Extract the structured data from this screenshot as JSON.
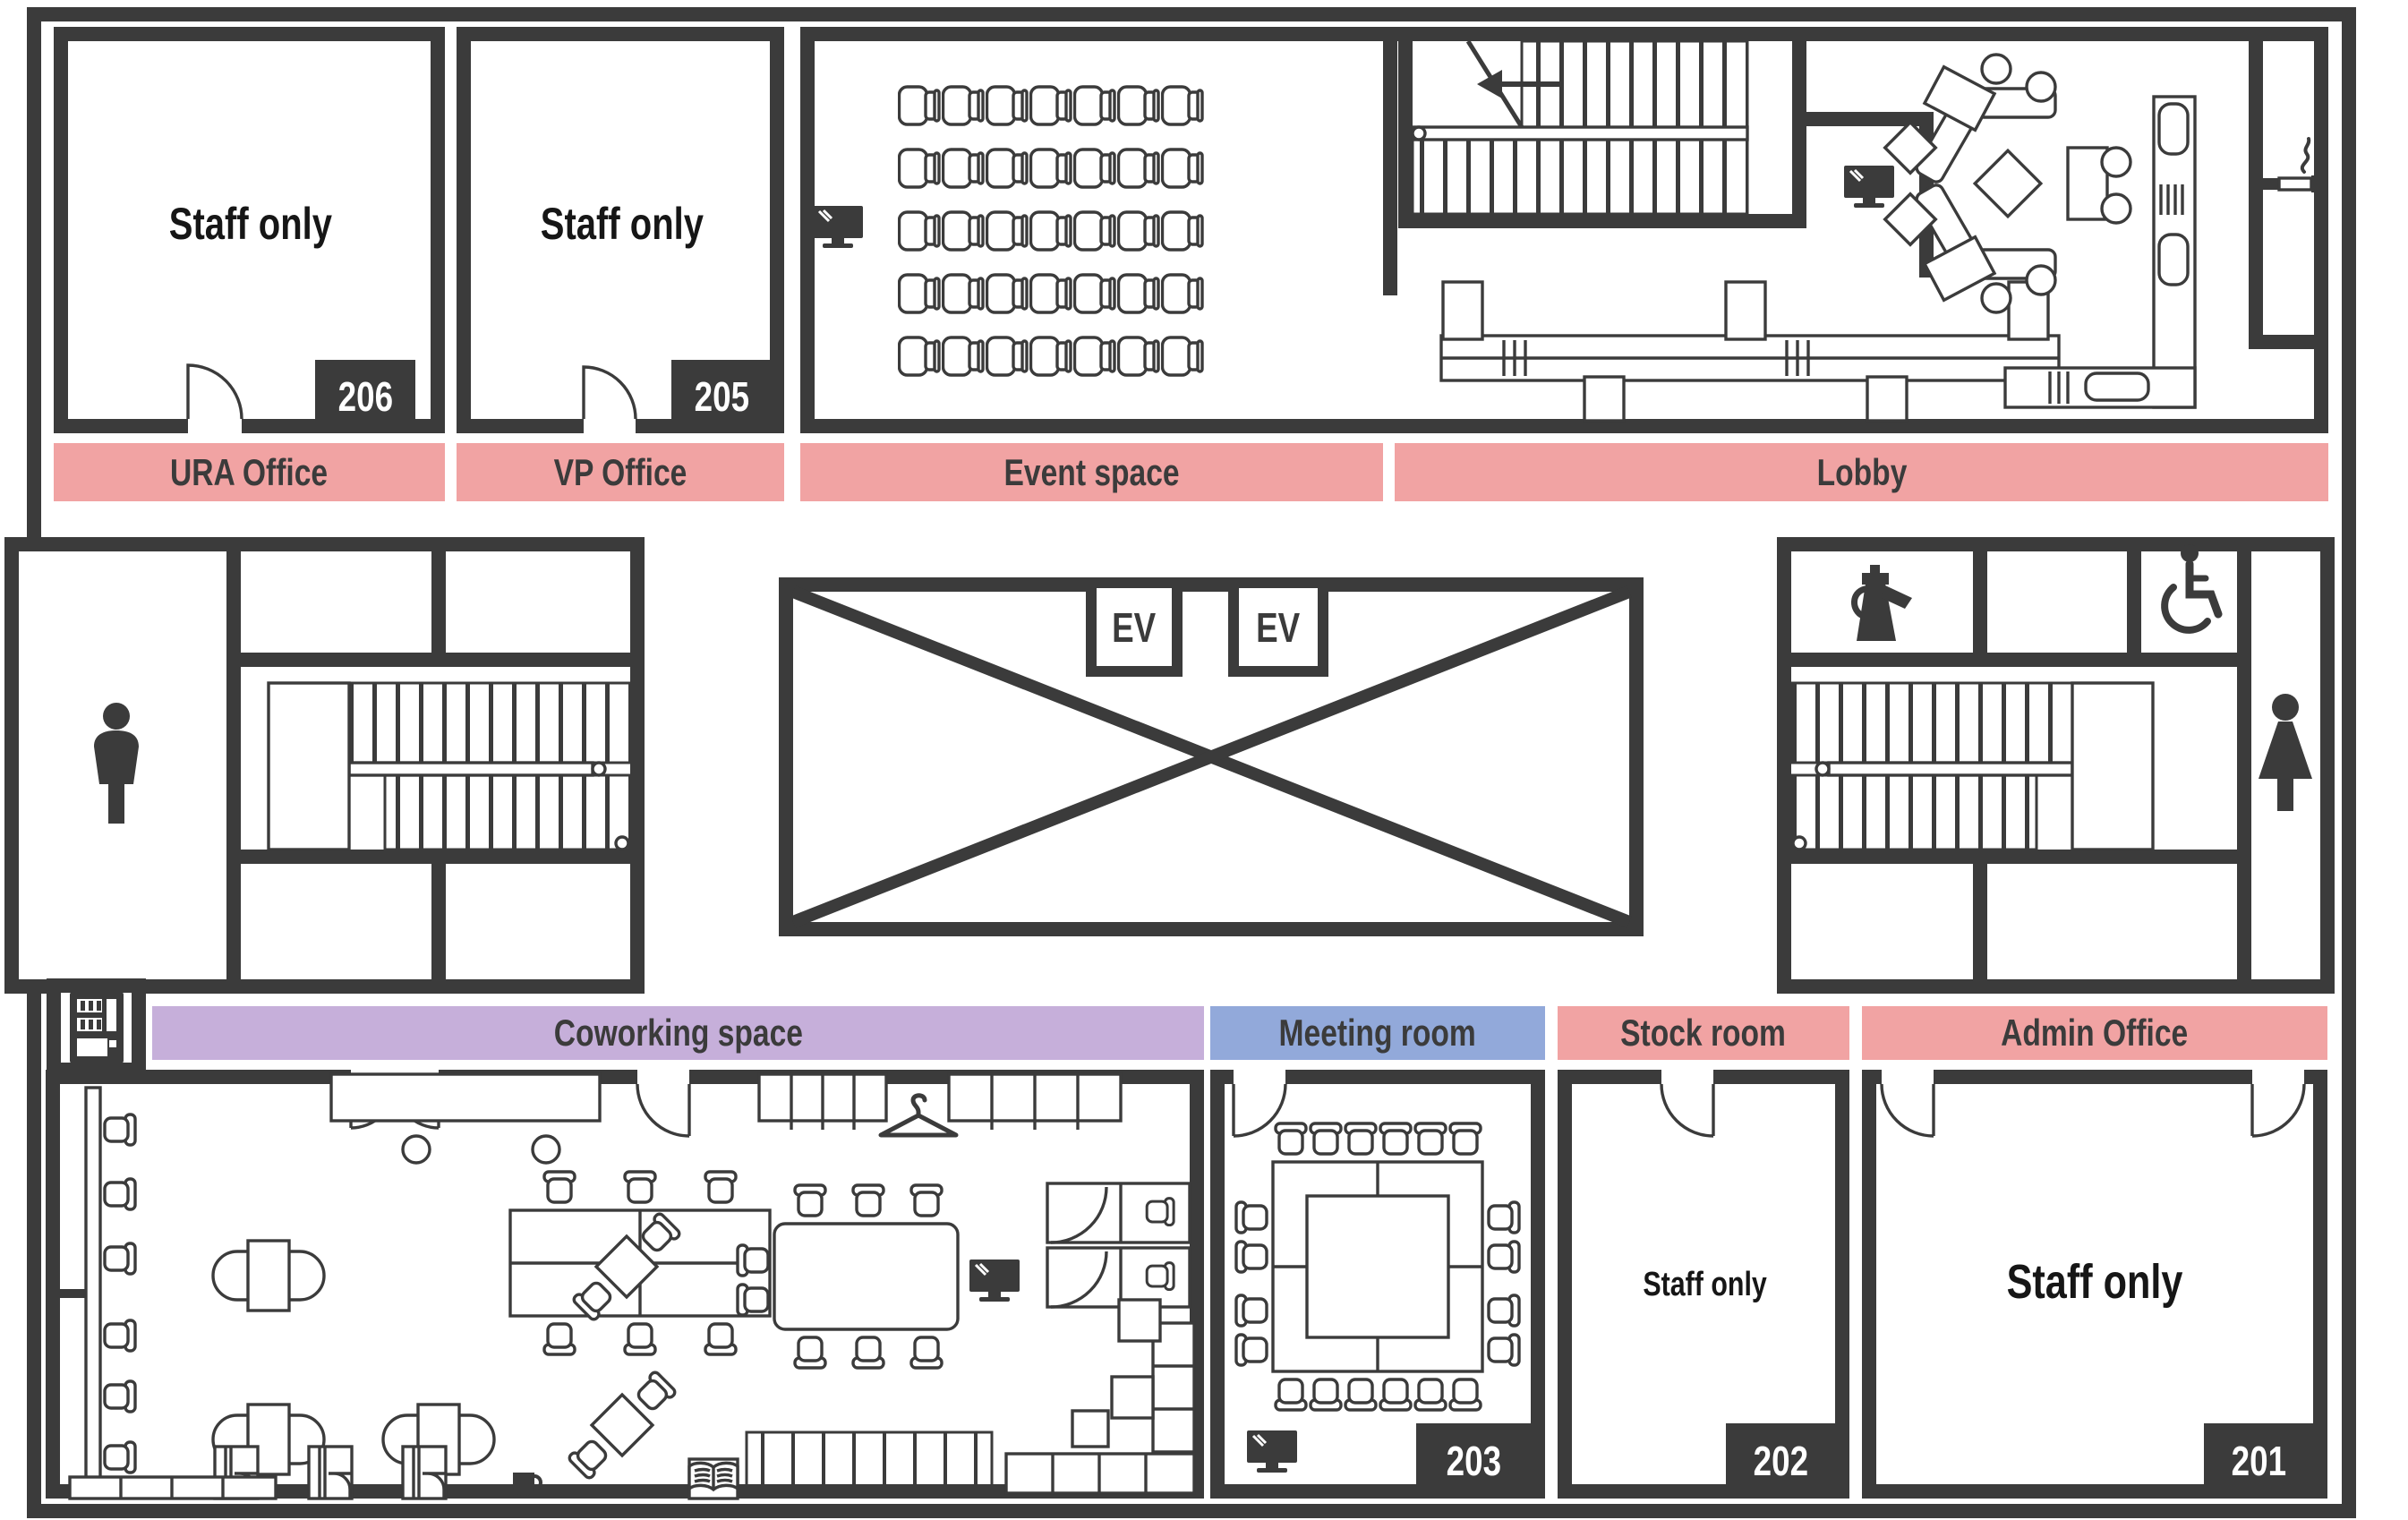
{
  "floor": {
    "type": "office-floor-plan",
    "colors": {
      "wall": "#3B3B3B",
      "zone_pink": "#F1A3A3",
      "zone_purple": "#C6AFDA",
      "zone_blue": "#92A9DA",
      "badge_bg": "#3B3B3B",
      "badge_text": "#FFFFFF"
    }
  },
  "zones": {
    "ura": {
      "label": "URA Office",
      "color": "#F1A3A3"
    },
    "vp": {
      "label": "VP Office",
      "color": "#F1A3A3"
    },
    "event": {
      "label": "Event space",
      "color": "#F1A3A3"
    },
    "lobby": {
      "label": "Lobby",
      "color": "#F1A3A3"
    },
    "coworking": {
      "label": "Coworking space",
      "color": "#C6AFDA"
    },
    "meeting": {
      "label": "Meeting room",
      "color": "#92A9DA"
    },
    "stock": {
      "label": "Stock room",
      "color": "#F1A3A3"
    },
    "admin": {
      "label": "Admin Office",
      "color": "#F1A3A3"
    }
  },
  "rooms": {
    "r206": {
      "text": "Staff only",
      "number": "206"
    },
    "r205": {
      "text": "Staff only",
      "number": "205"
    },
    "r203": {
      "number": "203"
    },
    "r202": {
      "text": "Staff only",
      "number": "202"
    },
    "r201": {
      "text": "Staff only",
      "number": "201"
    }
  },
  "elevator": {
    "label": "EV"
  },
  "icons": {
    "mens_restroom": "man-icon",
    "womens_restroom": "woman-icon",
    "accessible_restroom": "wheelchair-icon",
    "kitchenette": "coffee-pot-icon",
    "smoking_area": "cigarette-icon",
    "vending_machine": "vending-machine-icon",
    "tv_screens": "tv-icon",
    "coat_rack": "hanger-icon",
    "library_corner": "book-icon",
    "coffee_corner": "cup-icon"
  }
}
